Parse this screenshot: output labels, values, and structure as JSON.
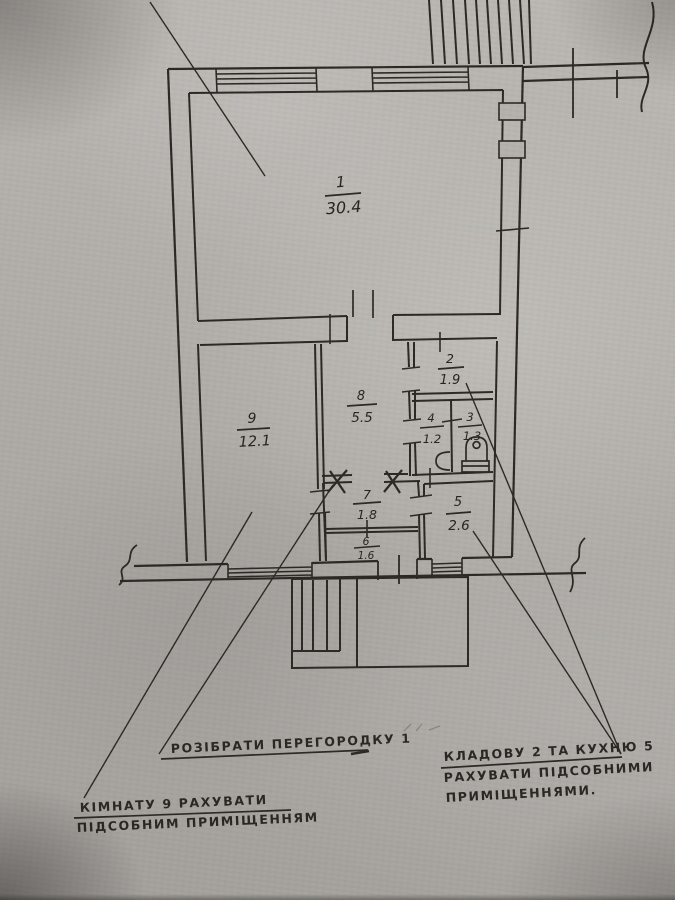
{
  "drawing": {
    "kind": "apartment floor plan (scanned hand drawing)",
    "language": "Ukrainian"
  },
  "rooms": {
    "r1": {
      "number": "1",
      "area": "30.4"
    },
    "r2": {
      "number": "2",
      "area": "1.9"
    },
    "r3": {
      "number": "3",
      "area": "1.3"
    },
    "r4": {
      "number": "4",
      "area": "1.2"
    },
    "r5": {
      "number": "5",
      "area": "2.6"
    },
    "r6": {
      "number": "6",
      "area": "1.6"
    },
    "r7": {
      "number": "7",
      "area": "1.8"
    },
    "r8": {
      "number": "8",
      "area": "5.5"
    },
    "r9": {
      "number": "9",
      "area": "12.1"
    }
  },
  "notes": {
    "demolish_partition": {
      "text": "РОЗІБРАТИ ПЕРЕГОРОДКУ 1"
    },
    "room9_auxiliary": {
      "line1": "КІМНАТУ 9 РАХУВАТИ",
      "line2": "ПІДСОБНИМ ПРИМІЩЕННЯМ"
    },
    "storage_kitchen_auxiliary": {
      "line1": "КЛАДОВУ 2 ТА КУХНЮ 5",
      "line2": "РАХУВАТИ ПІДСОБНИМИ",
      "line3": "ПРИМІЩЕННЯМИ."
    }
  },
  "colors": {
    "paper": "#b6b3ae",
    "ink": "#2c2824"
  }
}
